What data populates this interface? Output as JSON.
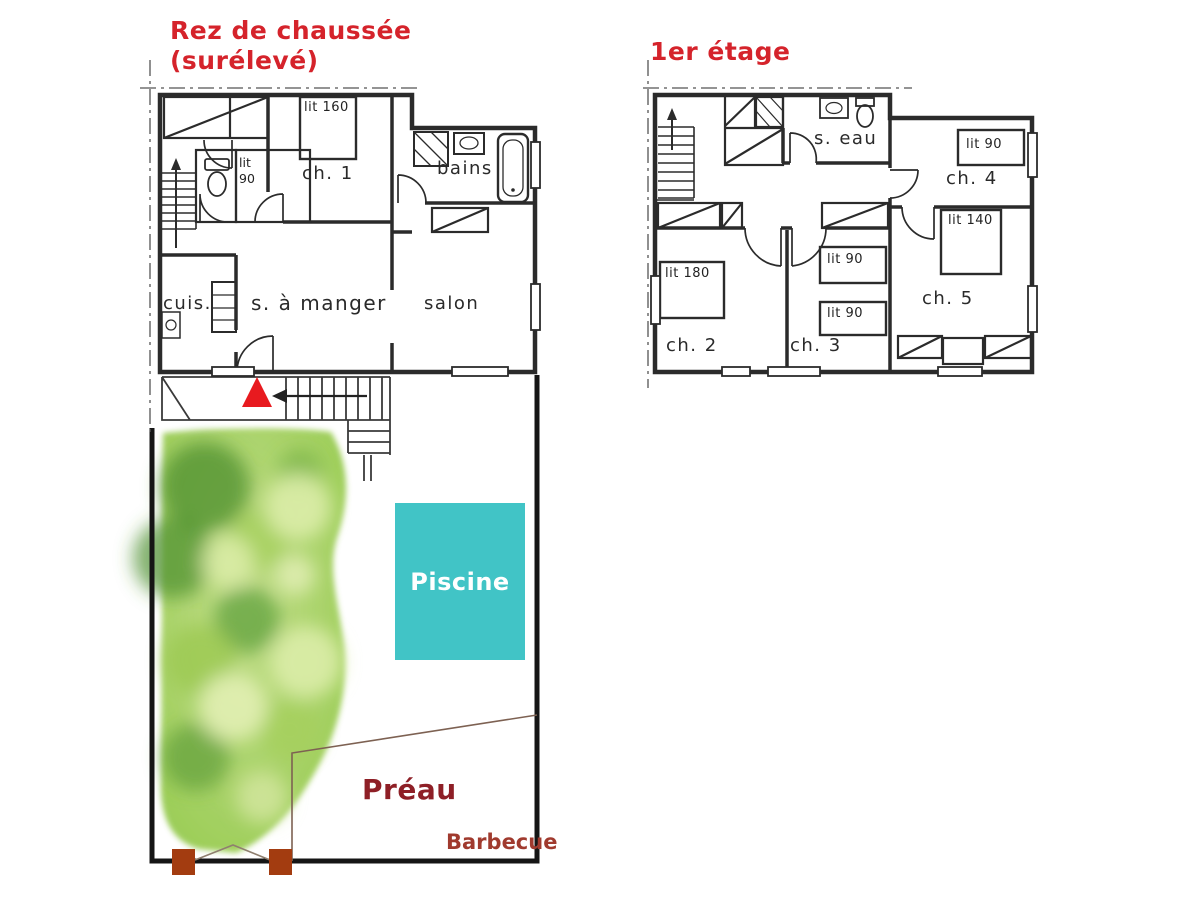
{
  "titles": {
    "ground_floor": "Rez de chaussée",
    "ground_floor_sub": "(surélevé)",
    "first_floor": "1er étage"
  },
  "ground_floor": {
    "ch1_label": "ch. 1",
    "ch1_bed": "lit 160",
    "small_room_bed_line1": "lit",
    "small_room_bed_line2": "90",
    "bathroom": "bains",
    "kitchen": "cuis.",
    "dining": "s. à manger",
    "living": "salon"
  },
  "first_floor": {
    "shower_room": "s. eau",
    "ch2_label": "ch. 2",
    "ch2_bed": "lit 180",
    "ch3_label": "ch. 3",
    "ch3_bed1": "lit 90",
    "ch3_bed2": "lit 90",
    "ch4_label": "ch. 4",
    "ch4_bed": "lit 90",
    "ch5_label": "ch. 5",
    "ch5_bed": "lit 140"
  },
  "outdoor": {
    "pool": "Piscine",
    "shelter": "Préau",
    "barbecue": "Barbecue"
  },
  "colors": {
    "title_red": "#d5232b",
    "entrance_marker_red": "#e81a1f",
    "pool_teal": "#41c4c6",
    "pool_text": "#ffffff",
    "shelter_text": "#8e1f26",
    "barbecue_text": "#a03a2e",
    "gate_post_brown": "#a33c10",
    "wall_black": "#2b2b2b",
    "garden_green": "#8cc63f"
  }
}
